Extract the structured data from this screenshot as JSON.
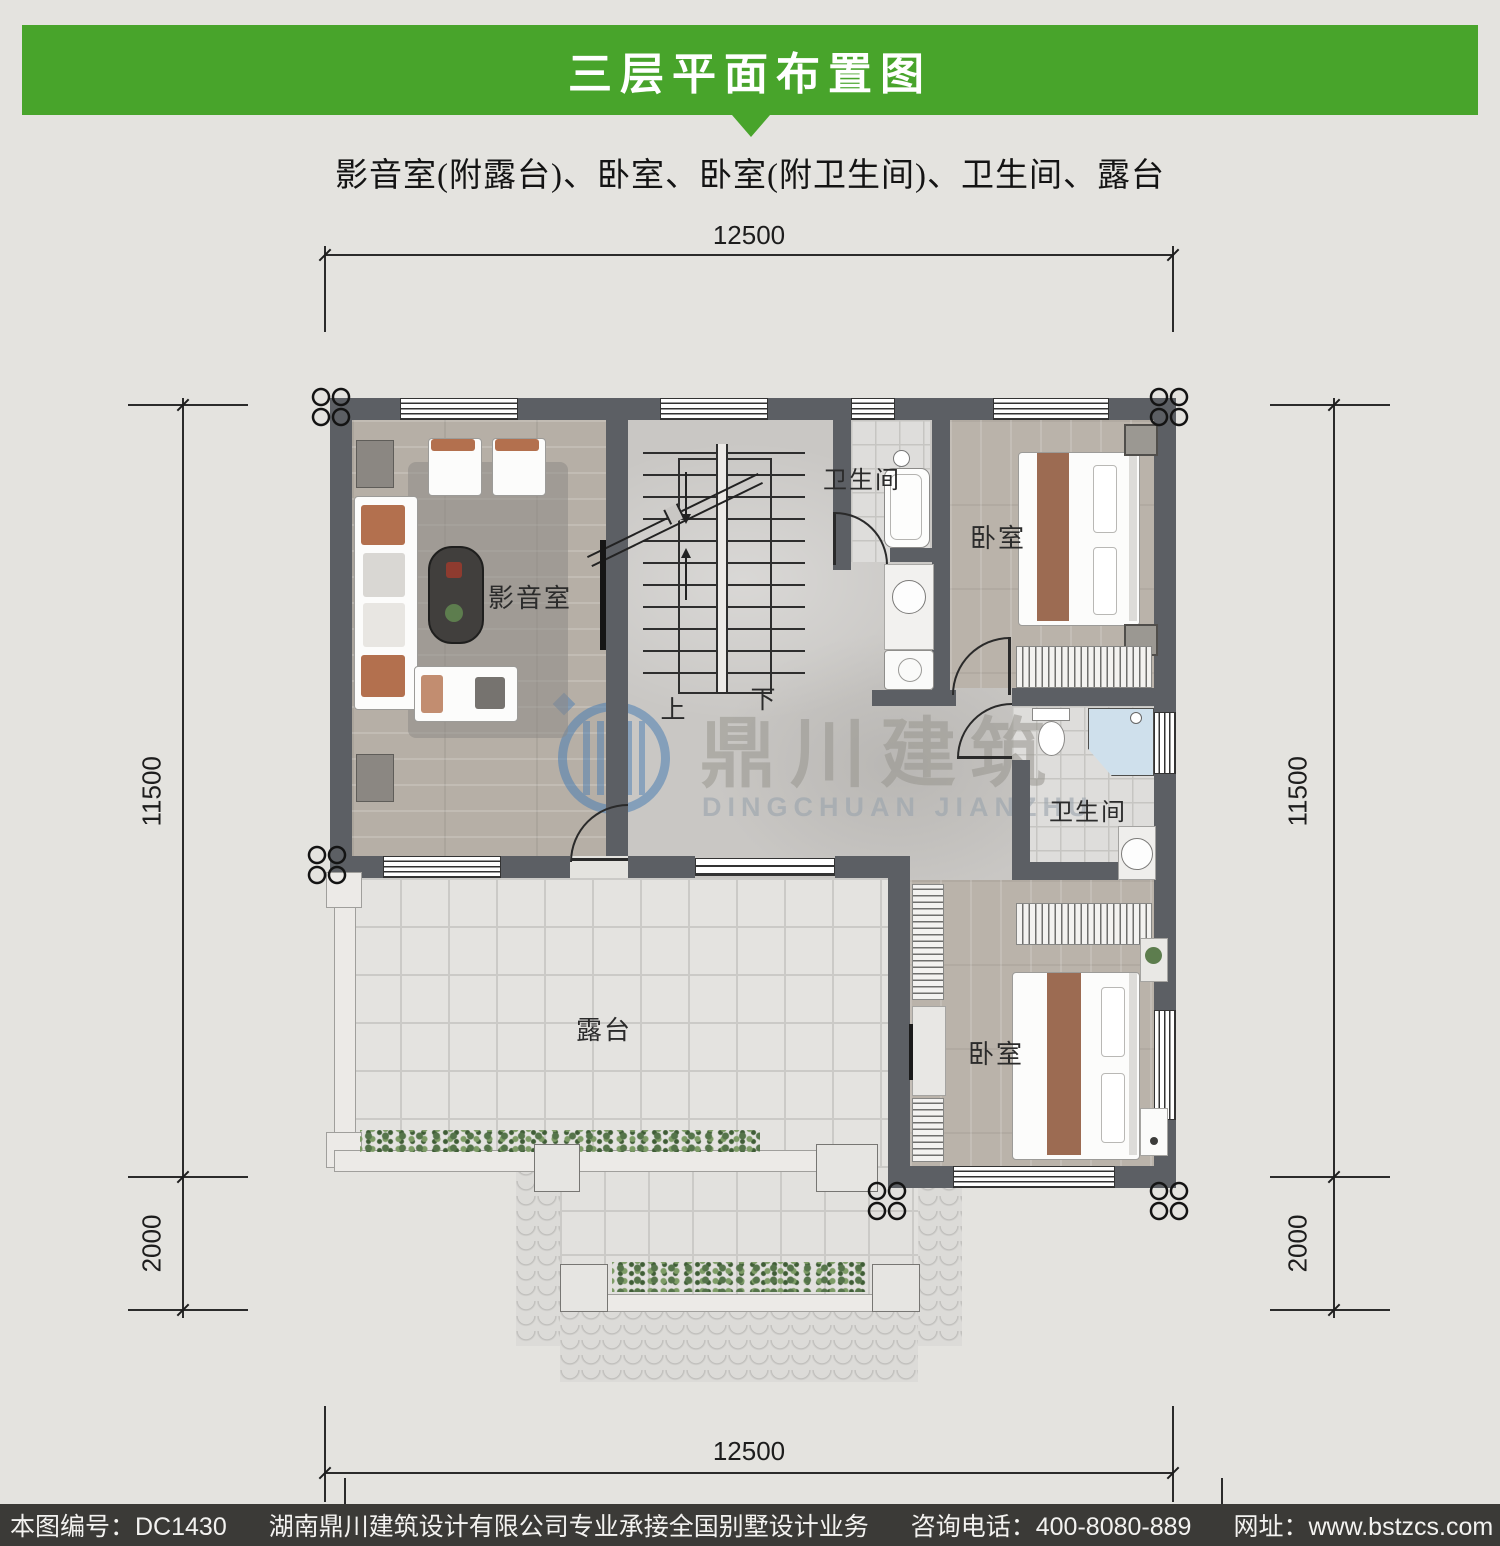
{
  "header": {
    "title": "三层平面布置图"
  },
  "subtitle": "影音室(附露台)、卧室、卧室(附卫生间)、卫生间、露台",
  "dimensions": {
    "top": "12500",
    "bottom": "12500",
    "left": {
      "main": "11500",
      "lower": "2000"
    },
    "right": {
      "main": "11500",
      "lower": "2000"
    }
  },
  "rooms": {
    "media_room": "影音室",
    "bathroom_top": "卫生间",
    "bedroom_top": "卧室",
    "bathroom_mid": "卫生间",
    "bedroom_bottom": "卧室",
    "terrace": "露台"
  },
  "stairs": {
    "up": "上",
    "down": "下"
  },
  "watermark": {
    "name_cn": "鼎川建筑",
    "name_en": "DINGCHUAN JIANZHU"
  },
  "footer": {
    "plan_no": "本图编号：DC1430",
    "company": "湖南鼎川建筑设计有限公司专业承接全国别墅设计业务",
    "phone": "咨询电话：400-8080-889",
    "website": "网址：www.bstzcs.com"
  },
  "colors": {
    "header_green": "#48a42b",
    "footer_bg": "#3b3a37",
    "wall_gray": "#5c5f64",
    "watermark_blue": "#4a7eb3",
    "shower_blue": "#cfe0ec",
    "accent_brown": "#b3704e"
  }
}
